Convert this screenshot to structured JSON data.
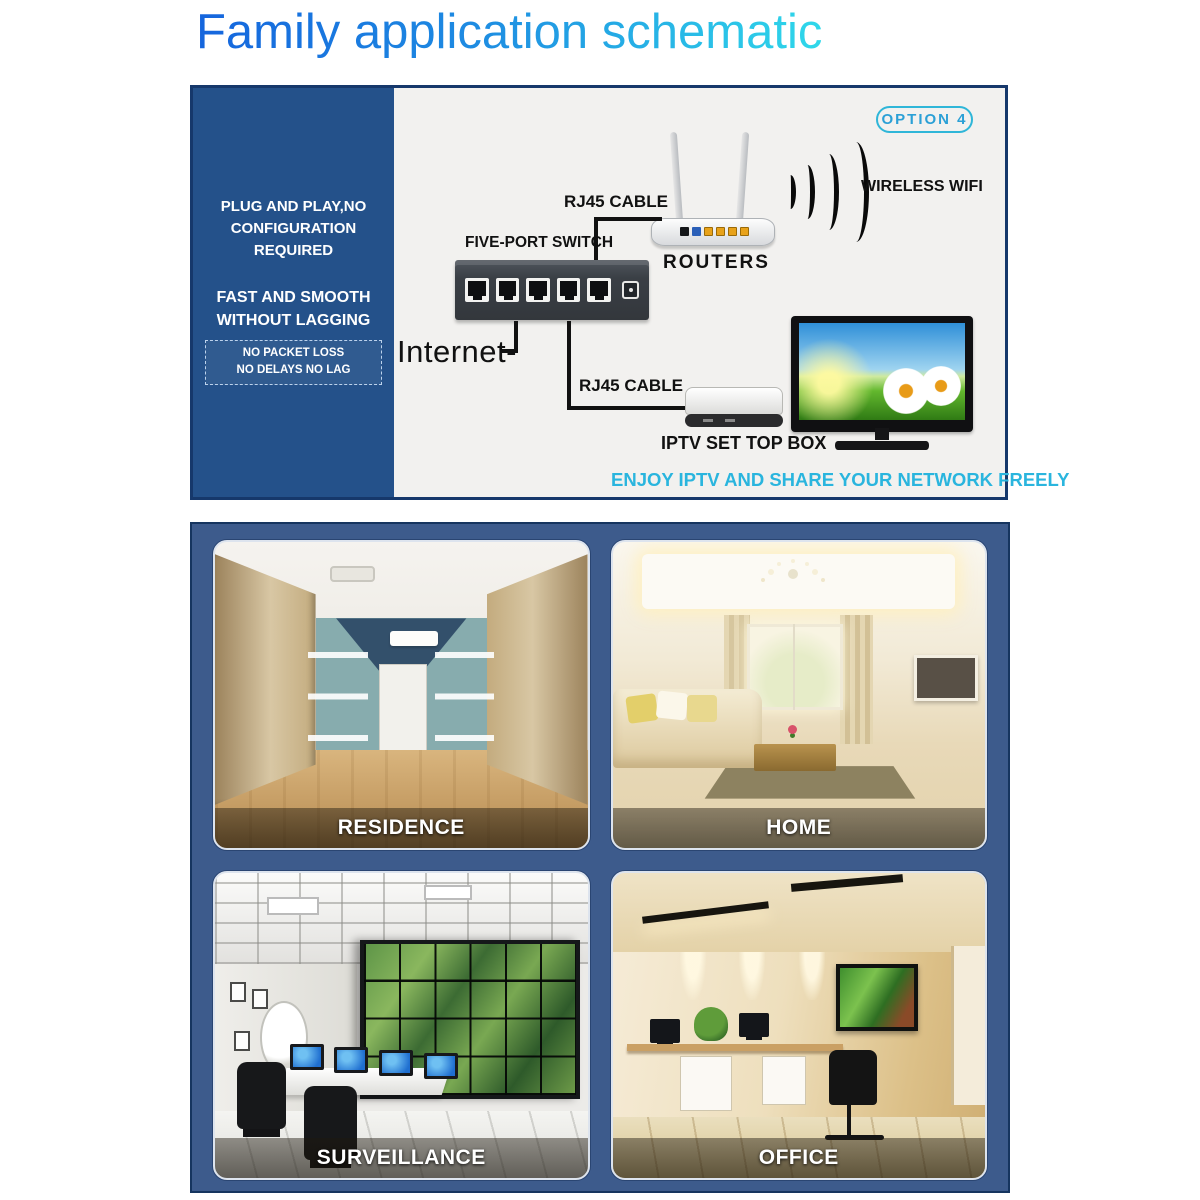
{
  "title": "Family application schematic",
  "diagram": {
    "option_badge": "OPTION 4",
    "sidebar": {
      "line1a": "PLUG AND PLAY,NO",
      "line1b": "CONFIGURATION REQUIRED",
      "line2a": "FAST AND SMOOTH",
      "line2b": "WITHOUT LAGGING",
      "box_line1": "NO PACKET LOSS",
      "box_line2": "NO DELAYS NO LAG"
    },
    "labels": {
      "five_port_switch": "FIVE-PORT SWITCH",
      "rj45_top": "RJ45 CABLE",
      "rj45_bottom": "RJ45 CABLE",
      "routers": "ROUTERS",
      "wireless_wifi": "WIRELESS WIFI",
      "internet": "Internet-",
      "iptv_set_top_box": "IPTV SET TOP BOX",
      "tagline": "ENJOY IPTV AND SHARE YOUR NETWORK FREELY"
    },
    "colors": {
      "sidebar_blue": "#24518a",
      "box_border_navy": "#16386b",
      "accent_cyan": "#2ab5de",
      "title_gradient_start": "#1565dd",
      "title_gradient_end": "#2fd8ea",
      "panel_navy": "#3d5b8c"
    },
    "icons": [
      "wifi-signal-icon",
      "router-icon",
      "five-port-switch-icon",
      "set-top-box-icon",
      "tv-icon"
    ]
  },
  "gallery": {
    "items": [
      {
        "label": "RESIDENCE"
      },
      {
        "label": "HOME"
      },
      {
        "label": "SURVEILLANCE"
      },
      {
        "label": "OFFICE"
      }
    ]
  }
}
